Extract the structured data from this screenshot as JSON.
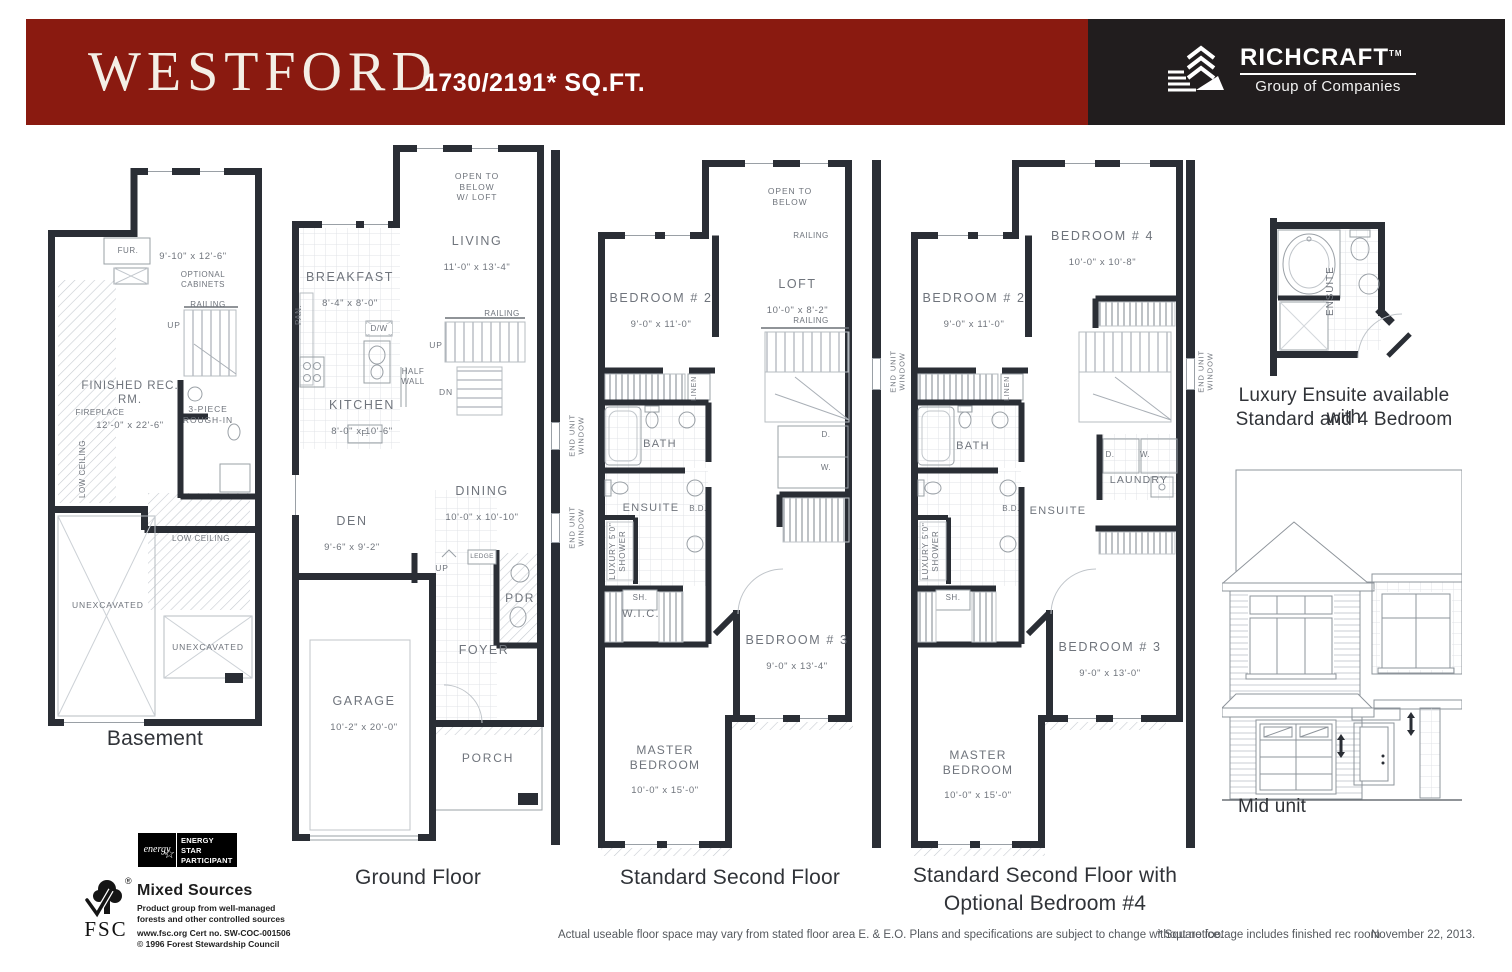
{
  "header": {
    "title": "WESTFORD",
    "sqft": "1730/2191* SQ.FT.",
    "brand": {
      "name": "RICHCRAFT",
      "tm": "TM",
      "subtitle": "Group of Companies"
    }
  },
  "basement": {
    "caption": "Basement",
    "fur": "FUR.",
    "dim_top": "9'-10\" x 12'-6\"",
    "optional_cabinets": "OPTIONAL\nCABINETS",
    "railing": "RAILING",
    "up": "UP",
    "rec_name": "FINISHED REC. RM.",
    "rec_dim": "12'-0\" x 22'-6\"",
    "fireplace": "FIREPLACE",
    "rough_in": "3-PIECE\nROUGH-IN",
    "low_ceiling_left": "LOW CEILING",
    "low_ceiling_right": "LOW CEILING",
    "unexcavated_left": "UNEXCAVATED",
    "unexcavated_right": "UNEXCAVATED"
  },
  "ground": {
    "caption": "Ground Floor",
    "open_below": "OPEN TO\nBELOW\nW/ LOFT",
    "living_name": "LIVING",
    "living_dim": "11'-0\" x 13'-4\"",
    "breakfast_name": "BREAKFAST",
    "breakfast_dim": "8'-4\" x 8'-0\"",
    "pan": "PAN.",
    "dw": "D/W",
    "half_wall": "HALF\nWALL",
    "kitchen_name": "KITCHEN",
    "kitchen_dim": "8'-0\" x 10'-6\"",
    "railing": "RAILING",
    "up": "UP",
    "dn": "DN",
    "f": "F.",
    "dining_name": "DINING",
    "dining_dim": "10'-0\" x 10'-10\"",
    "den_name": "DEN",
    "den_dim": "9'-6\" x 9'-2\"",
    "up2": "UP",
    "ledge": "LEDGE",
    "pdr": "PDR",
    "foyer": "FOYER",
    "garage_name": "GARAGE",
    "garage_dim": "10'-2\" x 20'-0\"",
    "porch": "PORCH"
  },
  "second": {
    "caption": "Standard Second Floor",
    "open_below": "OPEN TO\nBELOW",
    "railing_top": "RAILING",
    "railing_mid": "RAILING",
    "bed2_name": "BEDROOM # 2",
    "bed2_dim": "9'-0\" x 11'-0\"",
    "loft_name": "LOFT",
    "loft_dim": "10'-0\" x 8'-2\"",
    "linen": "LINEN",
    "bath": "BATH",
    "d": "D.",
    "w": "W.",
    "ensuite": "ENSUITE",
    "bd": "B.D.",
    "shower": "LUXURY 5'0\"\nSHOWER",
    "sh": "SH.",
    "wic": "W.I.C.",
    "bed3_name": "BEDROOM # 3",
    "bed3_dim": "9'-0\" x 13'-4\"",
    "master_name": "MASTER BEDROOM",
    "master_dim": "10'-0\" x 15'-0\"",
    "end_unit_window": "END UNIT\nWINDOW"
  },
  "optional": {
    "caption_line1": "Standard Second Floor with",
    "caption_line2": "Optional Bedroom #4",
    "bed4_name": "BEDROOM # 4",
    "bed4_dim": "10'-0\" x 10'-8\"",
    "bed2_name": "BEDROOM # 2",
    "bed2_dim": "9'-0\" x 11'-0\"",
    "linen": "LINEN",
    "bath": "BATH",
    "d": "D.",
    "w": "W.",
    "laundry": "LAUNDRY",
    "ensuite": "ENSUITE",
    "bd": "B.D.",
    "shower": "LUXURY 5'0\"\nSHOWER",
    "sh": "SH.",
    "bed3_name": "BEDROOM # 3",
    "bed3_dim": "9'-0\" x 13'-0\"",
    "master_name": "MASTER BEDROOM",
    "master_dim": "10'-0\" x 15'-0\"",
    "end_unit_window": "END UNIT\nWINDOW"
  },
  "ensuite_detail": {
    "room": "ENSUITE",
    "caption_line1": "Luxury Ensuite available with",
    "caption_line2": "Standard and 4 Bedroom"
  },
  "elevation": {
    "caption": "Mid unit"
  },
  "energy": {
    "script": "energy",
    "star": "☆",
    "line1": "ENERGY",
    "line2": "STAR",
    "line3": "PARTICIPANT"
  },
  "fsc": {
    "acronym": "FSC",
    "reg": "®",
    "title": "Mixed Sources",
    "desc": "Product group from well-managed\nforests and other controlled sources",
    "cert": "www.fsc.org   Cert no. SW-COC-001506",
    "copyright": "© 1996 Forest Stewardship Council"
  },
  "footer": {
    "disclaimer": "Actual useable floor space may vary from stated floor area E. & E.O. Plans and specifications are subject to change without notice.",
    "note": "* Square footage includes finished rec room",
    "date": "November 22, 2013."
  },
  "colors": {
    "banner_red": "#8a1a10",
    "banner_spine": "#5e120b",
    "logo_panel": "#211d1e",
    "wall": "#2a2e35"
  }
}
